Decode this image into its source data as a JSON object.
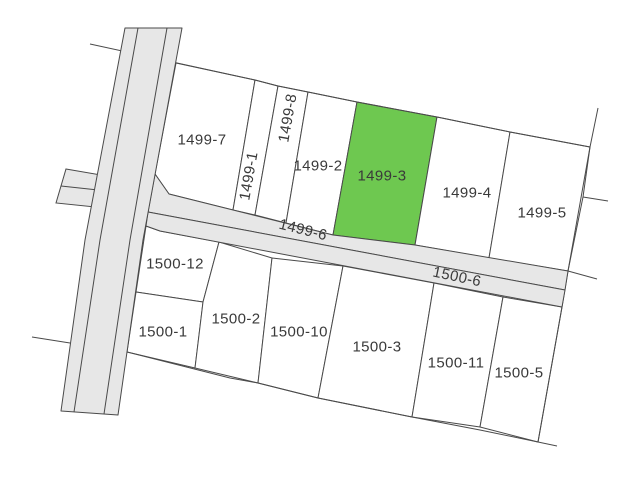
{
  "map": {
    "type": "cadastral-parcel-map",
    "highlighted_parcel": "1499-3",
    "colors": {
      "background": "#ffffff",
      "line": "#4a4a4a",
      "road_fill": "#e7e7e7",
      "parcel_fill": "#ffffff",
      "highlight_fill": "#6ec850",
      "label_color": "#3a3a3a"
    },
    "label_font_size": 15,
    "parcels": [
      {
        "id": "1499-7",
        "label": "1499-7",
        "points": "176,63 255,80 233,210 169,194 155,174",
        "label_x": 202,
        "label_y": 140,
        "rotation": 0,
        "highlighted": false
      },
      {
        "id": "1499-1",
        "label": "1499-1",
        "points": "255,80 278,86 255,215 233,210",
        "label_x": 249,
        "label_y": 176,
        "rotation": -80,
        "highlighted": false
      },
      {
        "id": "1499-8",
        "label": "1499-8",
        "points": "278,86 308,92 286,223 255,215",
        "label_x": 288,
        "label_y": 118,
        "rotation": -80,
        "highlighted": false
      },
      {
        "id": "1499-2",
        "label": "1499-2",
        "points": "308,92 357,102 333,235 286,223",
        "label_x": 318,
        "label_y": 166,
        "rotation": 0,
        "highlighted": false
      },
      {
        "id": "1499-3",
        "label": "1499-3",
        "points": "357,102 437,117 415,245 333,235",
        "label_x": 382,
        "label_y": 176,
        "rotation": 0,
        "highlighted": true
      },
      {
        "id": "1499-4",
        "label": "1499-4",
        "points": "437,117 510,132 489,258 415,245",
        "label_x": 467,
        "label_y": 193,
        "rotation": 0,
        "highlighted": false
      },
      {
        "id": "1499-5",
        "label": "1499-5",
        "points": "510,132 590,147 568,271 489,258",
        "label_x": 542,
        "label_y": 213,
        "rotation": 0,
        "highlighted": false
      },
      {
        "id": "1500-12",
        "label": "1500-12",
        "points": "146,226 160,231 219,242 203,302 136,292",
        "label_x": 175,
        "label_y": 264,
        "rotation": 0,
        "highlighted": false
      },
      {
        "id": "1500-1",
        "label": "1500-1",
        "points": "136,292 203,302 195,368 127,352",
        "label_x": 163,
        "label_y": 332,
        "rotation": 0,
        "highlighted": false
      },
      {
        "id": "1500-2",
        "label": "1500-2",
        "points": "219,242 272,258 258,383 195,368 203,302",
        "label_x": 236,
        "label_y": 319,
        "rotation": 0,
        "highlighted": false
      },
      {
        "id": "1500-10",
        "label": "1500-10",
        "points": "272,258 343,266 318,398 258,383",
        "label_x": 299,
        "label_y": 332,
        "rotation": 0,
        "highlighted": false
      },
      {
        "id": "1500-3",
        "label": "1500-3",
        "points": "343,266 434,283 412,417 318,398",
        "label_x": 377,
        "label_y": 347,
        "rotation": 0,
        "highlighted": false
      },
      {
        "id": "1500-11",
        "label": "1500-11",
        "points": "434,283 503,297 480,427 412,417",
        "label_x": 456,
        "label_y": 363,
        "rotation": 0,
        "highlighted": false
      },
      {
        "id": "1500-5",
        "label": "1500-5",
        "points": "503,297 562,307 538,442 480,427",
        "label_x": 519,
        "label_y": 373,
        "rotation": 0,
        "highlighted": false
      }
    ],
    "road_parcels": [
      {
        "id": "1499-6",
        "label": "1499-6",
        "points": "155,174 169,194 333,235 415,245 568,271 565,290 148,212",
        "label_x": 303,
        "label_y": 230,
        "rotation": 14
      },
      {
        "id": "1500-6",
        "label": "1500-6",
        "points": "148,212 565,290 562,307 160,231 146,226",
        "label_x": 457,
        "label_y": 277,
        "rotation": 12
      }
    ],
    "roads": {
      "vertical_road": {
        "outline": "125,28 182,28 143,240 118,415 61,411 85,240",
        "lane_lines": [
          "138,28 100,240 74,412",
          "167,28 130,240 104,414"
        ]
      },
      "branch_road": {
        "outline": "66,169 101,175 95,207 56,203",
        "center_line": "61,186 98,190"
      }
    },
    "boundary_lines": [
      {
        "name": "top-boundary",
        "points": "90,44 177,63 255,80 278,86 308,92 357,102 437,117 510,132 590,147"
      },
      {
        "name": "right-boundary",
        "points": "598,108 590,147 583,197 568,271 562,307 538,442"
      },
      {
        "name": "right-stub",
        "points": "583,197 608,201"
      },
      {
        "name": "road-end-stub",
        "points": "568,271 597,279"
      },
      {
        "name": "bottom-stub",
        "points": "538,442 557,446"
      },
      {
        "name": "bottom-boundary",
        "points": "32,337 127,352 230,378 258,383 318,398 412,417 480,430 538,442"
      }
    ]
  }
}
